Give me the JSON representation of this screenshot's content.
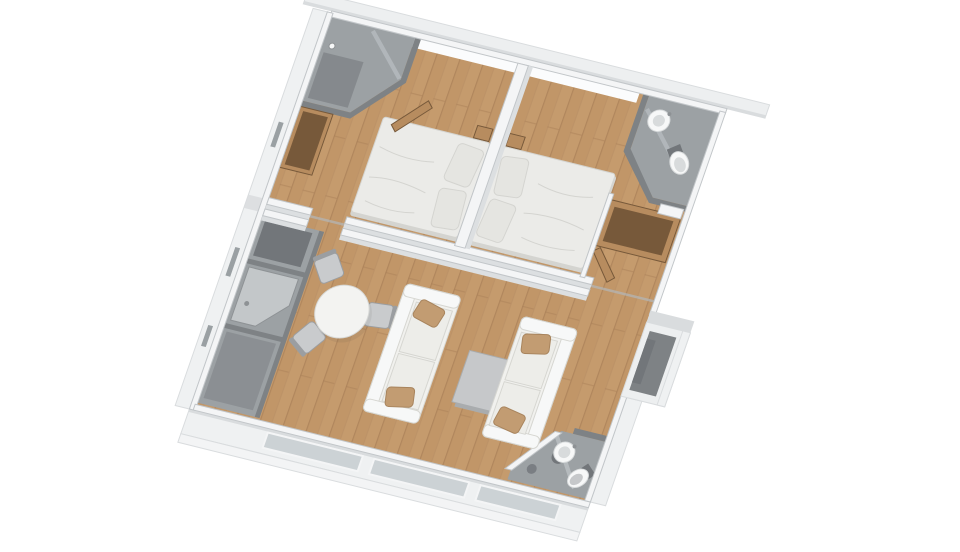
{
  "image": {
    "description": "3D rendered top-down floor plan of a two-bedroom modular home",
    "background": "#ffffff"
  },
  "palette": {
    "wood": "#c59b6d",
    "woodAlt": "#bd9264",
    "woodLine": "#a97f58",
    "wallTop": "#f4f5f6",
    "wallFace": "#dcdfe1",
    "wallEdge": "#c2c6c9",
    "rim": "#edeff0",
    "rimShade": "#d9dcde",
    "outerFace": "#eff1f2",
    "plinth": "#f3f4f5",
    "grayFloor": "#9ca1a4",
    "grayWall": "#7e8285",
    "grayDark": "#72767a",
    "counter": "#c3c7c9",
    "glass": "#c6cccf",
    "windowGlass": "#ccd2d5",
    "windowGlow": "#fbfcfd",
    "fixture": "#f7f8f8",
    "fixtureShade": "#d8dbdc",
    "metal": "#8e9295",
    "sofa": "#f1f1ee",
    "sofaShade": "#d6d6d1",
    "cushion": "#edede9",
    "pillowTan": "#c29c72",
    "pillowTanDark": "#a8845d",
    "duvet": "#ebebe8",
    "duvetShade": "#d4d4d0",
    "pillowWhite": "#e5e5e1",
    "tableTop": "#f3f3f1",
    "tableEdge": "#d7d8d6",
    "coffeeTop": "#c6c8ca",
    "coffeeSide": "#a9acae",
    "woodFurn": "#b78c5f",
    "woodFurnDark": "#77593a",
    "chairSeat": "#c9cbcd",
    "chairFrame": "#9b9ea1",
    "slit": "#9aa0a3",
    "seamShadow": "#b2b6b9"
  },
  "rooms": [
    "bedroom-1",
    "bedroom-2",
    "ensuite-shower-room",
    "ensuite-bathroom",
    "living-room",
    "dining-area",
    "kitchenette-utility",
    "bathroom-lower-right",
    "entry-porch"
  ],
  "furniture": [
    "double-bed",
    "double-bed",
    "nightstand",
    "nightstand",
    "wardrobe",
    "dresser",
    "sofa",
    "sofa",
    "coffee-table",
    "round-dining-table",
    "dining-chair",
    "dining-chair",
    "dining-chair",
    "wash-basin",
    "wash-basin",
    "toilet",
    "toilet",
    "shower",
    "kitchen-counter"
  ]
}
